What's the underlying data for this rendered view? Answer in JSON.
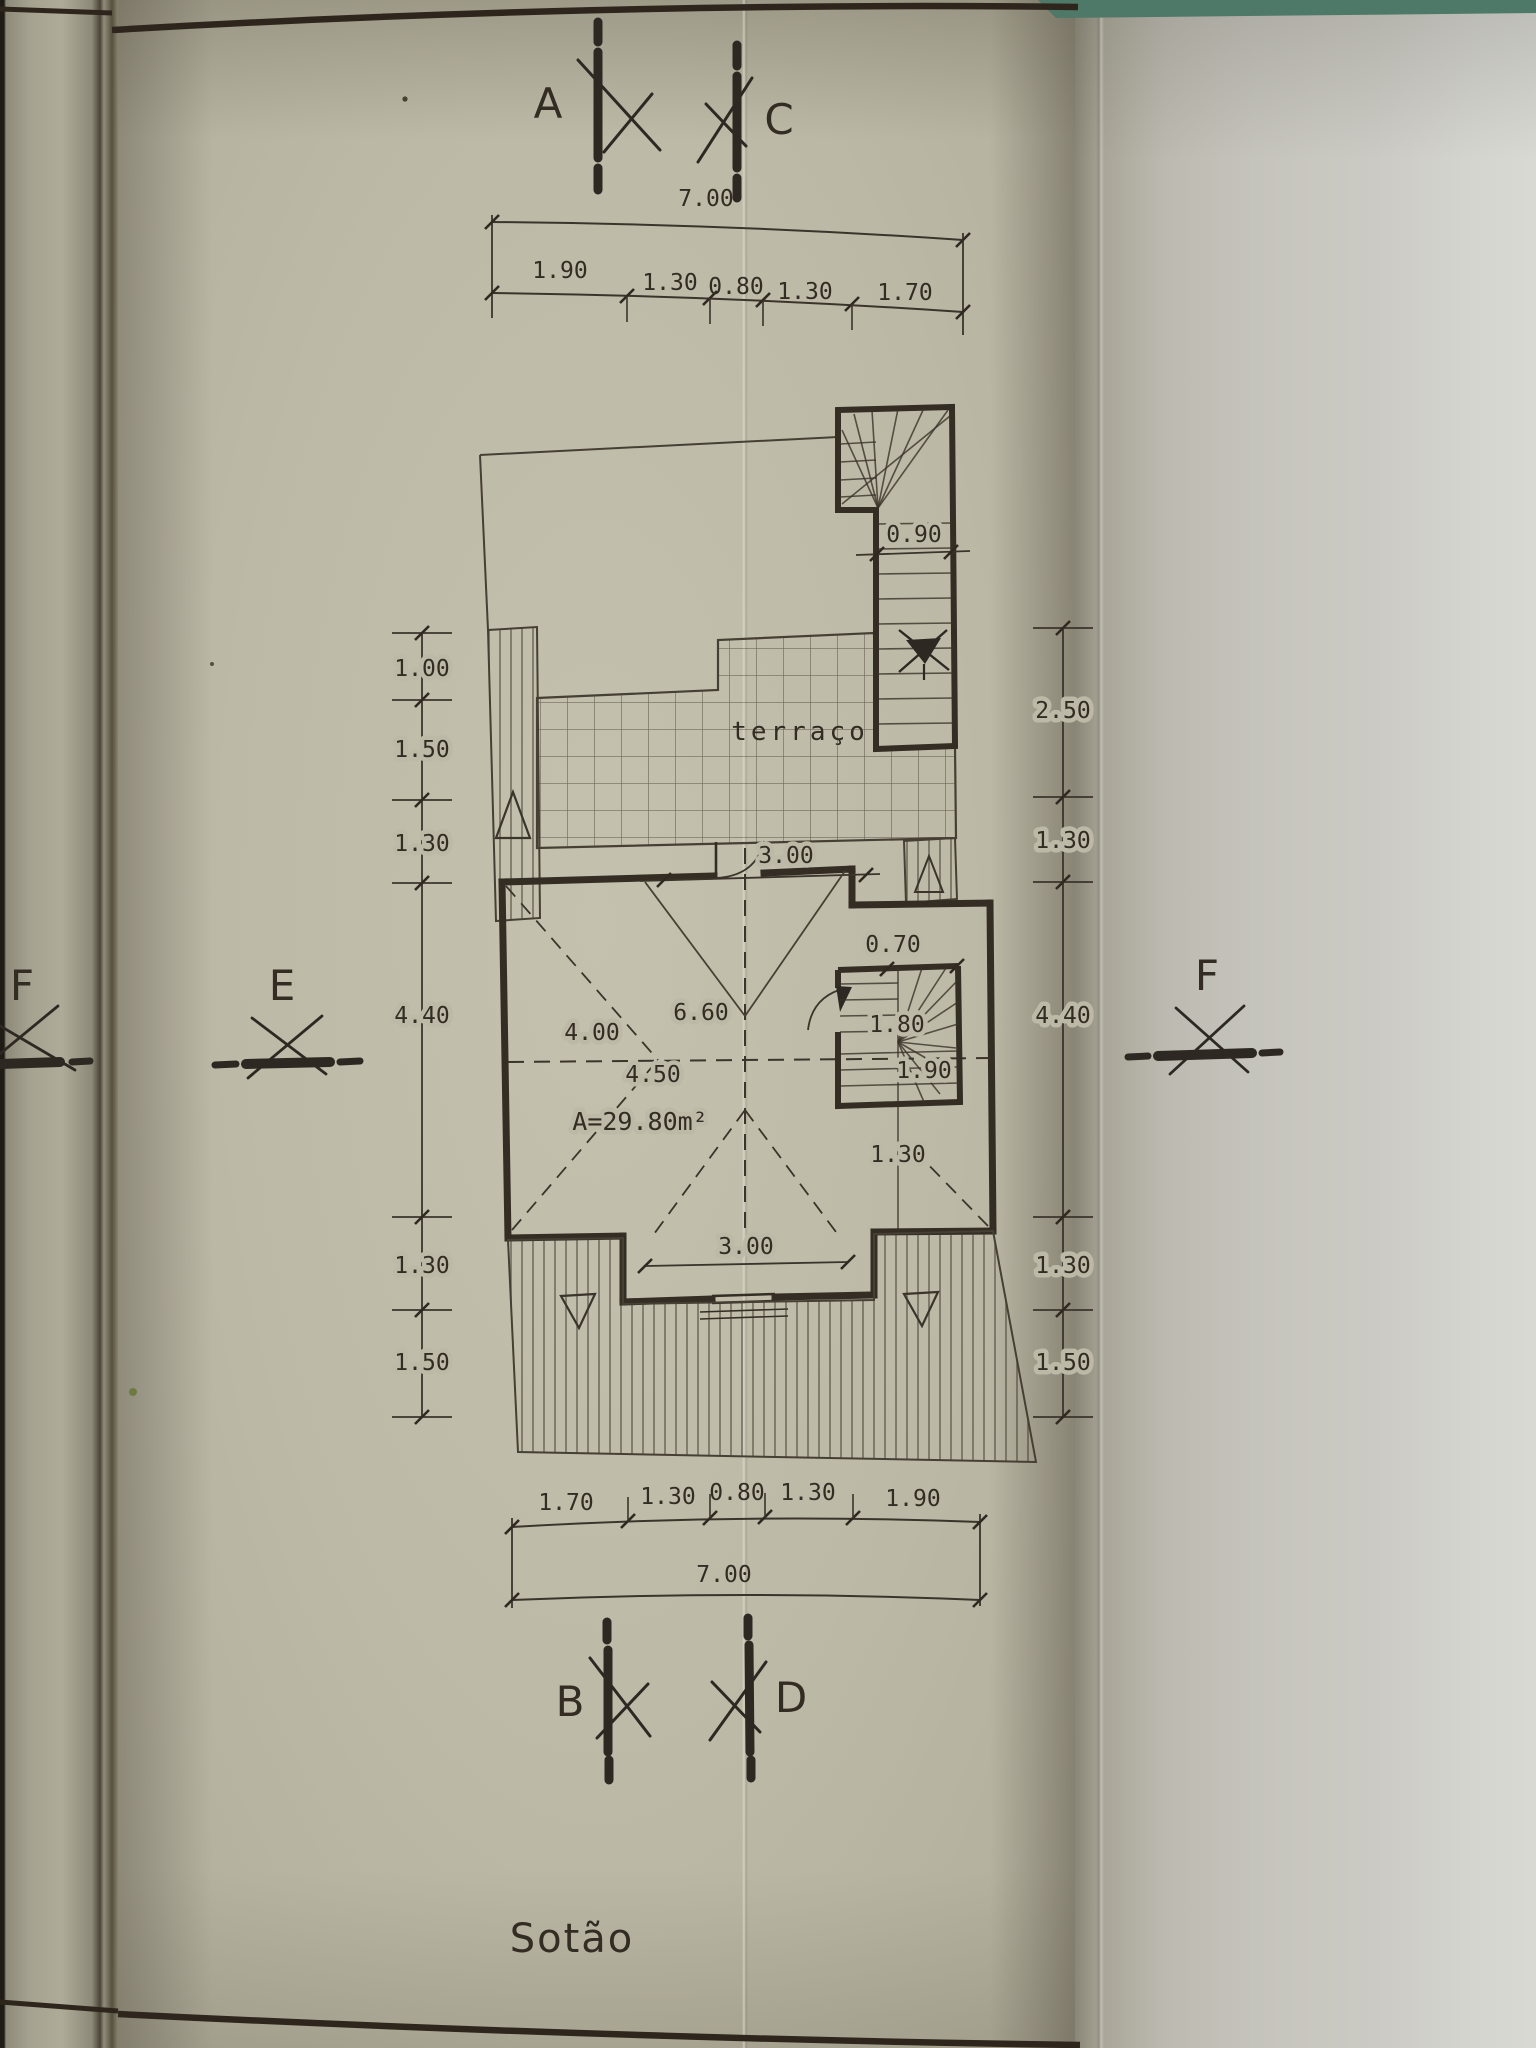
{
  "title": "Sotão",
  "labels": {
    "room": "terraço",
    "area": "A=29.80m²"
  },
  "markers": {
    "a": "A",
    "c": "C",
    "b": "B",
    "d": "D",
    "e": "E",
    "f_right": "F",
    "f_left": "F"
  },
  "dims": {
    "top": {
      "total": "7.00",
      "segments": [
        "1.90",
        "1.30",
        "0.80",
        "1.30",
        "1.70"
      ]
    },
    "bottom": {
      "total": "7.00",
      "segments": [
        "1.70",
        "1.30",
        "0.80",
        "1.30",
        "1.90"
      ]
    },
    "left": [
      "1.00",
      "1.50",
      "1.30",
      "4.40",
      "1.30",
      "1.50"
    ],
    "right": [
      "2.50",
      "1.30",
      "4.40",
      "1.30",
      "1.50"
    ],
    "interior": {
      "stair_top_width": "0.90",
      "terrace_door": "3.00",
      "landing": "0.70",
      "stair_width": "1.80",
      "stair_length": "1.90",
      "below_stair": "1.30",
      "room_left": "4.00",
      "room_diagonal": "6.60",
      "room_mid": "4.50",
      "bottom_window": "3.00"
    }
  },
  "colors": {
    "paper": "#bdb9a7",
    "ink": "#332d24",
    "table_edge_teal": "#4e7868"
  }
}
